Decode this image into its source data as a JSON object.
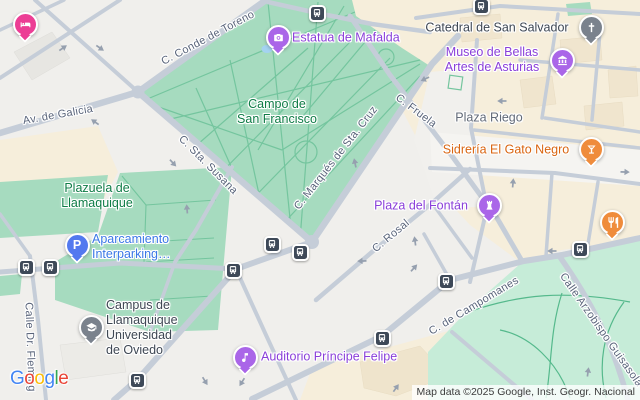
{
  "attribution": {
    "text": "Map data ©2025 Google, Inst. Geogr. Nacional"
  },
  "logo": {
    "letters": [
      "G",
      "o",
      "o",
      "g",
      "l",
      "e"
    ]
  },
  "streets": {
    "conde_toreno": "C. Conde de Toreno",
    "av_galicia": "Av. de Galicia",
    "sta_susana": "C. Sta. Susana",
    "marques_sta_cruz": "C. Marqués de Sta. Cruz",
    "fruela": "C. Fruela",
    "rosal": "C. Rosal",
    "campomanes": "C. de Campomanes",
    "arzobispo": "Calle Arzobispo Guisasola",
    "dr_fleming": "Calle Dr. Fleming"
  },
  "areas": {
    "campo": {
      "line1": "Campo de",
      "line2": "San Francisco"
    },
    "plazuela": {
      "line1": "Plazuela de",
      "line2": "Llamaquique"
    },
    "plaza_riego": "Plaza Riego"
  },
  "pois": {
    "estatua": {
      "label": "Estatua de Mafalda",
      "icon": "camera-icon"
    },
    "catedral": {
      "label": "Catedral de San Salvador",
      "icon": "church-cross-icon"
    },
    "museo": {
      "line1": "Museo de Bellas",
      "line2": "Artes de Asturias",
      "icon": "museum-icon"
    },
    "sidreria": {
      "label": "Sidrería El Gato Negro",
      "icon": "bar-cocktail-icon"
    },
    "fontan": {
      "label": "Plaza del Fontán",
      "icon": "historic-site-icon"
    },
    "parking": {
      "line1": "Aparcamiento",
      "line2": "Interparking…",
      "letter": "P",
      "icon": "parking-icon"
    },
    "campus": {
      "line1": "Campus de",
      "line2": "Llamaquique",
      "line3": "Universidad",
      "line4": "de Oviedo",
      "icon": "school-icon"
    },
    "auditorio": {
      "label": "Auditorio Príncipe Felipe",
      "icon": "music-note-icon"
    },
    "hotel": {
      "icon": "hotel-bed-icon"
    },
    "restaurant": {
      "icon": "restaurant-icon"
    }
  },
  "transit": {
    "icon": "bus-icon",
    "stop_count": 11
  },
  "colors": {
    "background": "#F0EFEC",
    "road": "#C5CDD8",
    "park_green": "#A6DBBF",
    "park_green_light": "#C6ECD8",
    "beige_block": "#F6EEDB",
    "purple_label": "#8A3FD9",
    "purple_pin": "#AA66E8",
    "orange_label": "#D96511",
    "orange_pin": "#EF8C3C",
    "blue_label": "#3B78E7",
    "parking_blue": "#5379EF",
    "pink_pin": "#EC3E95",
    "gray_pin": "#7A828D",
    "green_label": "#0E7C46",
    "street_label": "#59647A",
    "bus_marker": "#3E4958"
  }
}
